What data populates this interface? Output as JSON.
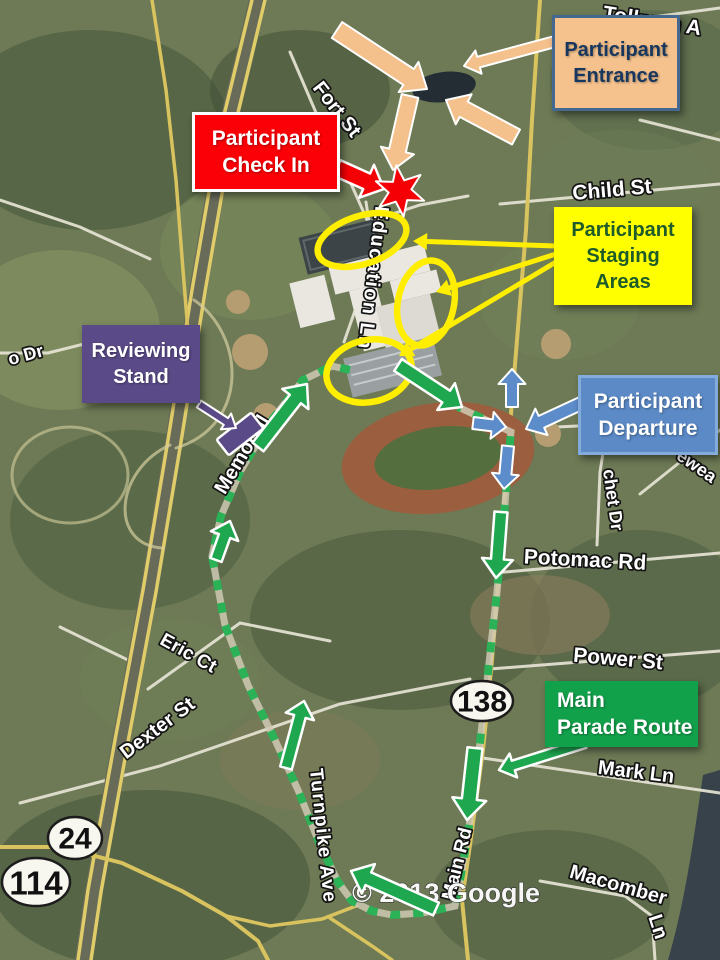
{
  "callouts": {
    "entrance": {
      "line1": "Participant",
      "line2": "Entrance"
    },
    "check_in": {
      "line1": "Participant",
      "line2": "Check In"
    },
    "staging": {
      "line1": "Participant",
      "line2": "Staging",
      "line3": "Areas"
    },
    "reviewing_stand": {
      "line1": "Reviewing",
      "line2": "Stand"
    },
    "departure": {
      "line1": "Participant",
      "line2": "Departure"
    },
    "main_route": {
      "line1": "Main",
      "line2": "Parade Route"
    }
  },
  "streets": {
    "tollman": "Tollman A",
    "fort": "Fort St",
    "child": "Child St",
    "education": "Education Ln",
    "memorial": "Memorial",
    "o_dr": "o Dr",
    "chet_dr": "chet Dr",
    "ewea": "ewea",
    "potomac": "Potomac Rd",
    "power": "Power St",
    "eric": "Eric Ct",
    "dexter": "Dexter St",
    "turnpike": "Turnpike Ave",
    "main_rd": "Main Rd",
    "mark": "Mark Ln",
    "macomber": "Macomber",
    "macomber_ln": "Ln"
  },
  "shields": {
    "route_138": "138",
    "route_24": "24",
    "route_114": "114"
  },
  "watermark": "© 2013 Google",
  "colors": {
    "entrance_fill": "#F5C28E",
    "entrance_border": "#44688F",
    "entrance_text": "#17375E",
    "checkin_fill": "#FB0007",
    "checkin_text": "#FFFFFF",
    "staging_fill": "#FFFF00",
    "staging_text": "#1E5B2A",
    "reviewing_fill": "#5A4A87",
    "reviewing_text": "#FFFFFF",
    "departure_fill": "#5B8AC7",
    "departure_border": "#83ABDB",
    "departure_text": "#FFFFFF",
    "route_fill": "#12A14B",
    "route_text": "#FFFFFF",
    "parade_route_green": "#2BB156",
    "arrow_green": "#1FA750",
    "arrow_blue": "#5C8CC9",
    "arrow_peach": "#F4C08C",
    "arrow_red": "#F50005",
    "staging_yellow": "#FFEE00",
    "star_red": "#F50005"
  }
}
